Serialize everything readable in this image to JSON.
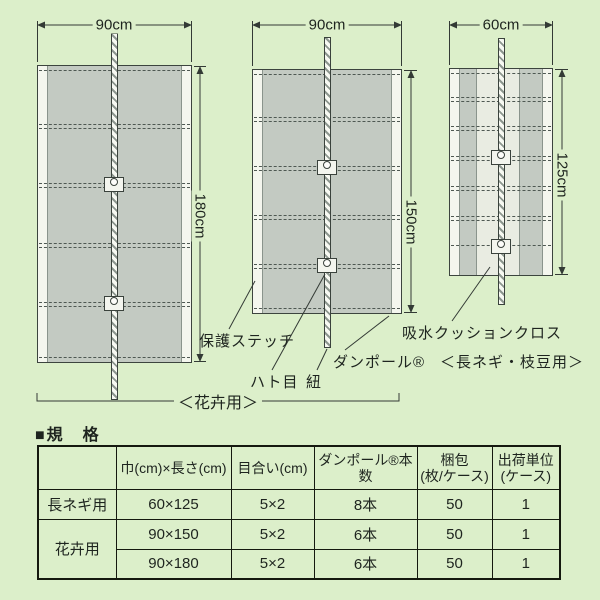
{
  "colors": {
    "background": "#dcefca",
    "panel_gray": "#c3cac2",
    "stitch_white": "#f4f6ee",
    "cushion_light": "#e9ece2",
    "line": "#333a35"
  },
  "diagram": {
    "panels": [
      {
        "width_label": "90cm",
        "height_label": "180cm"
      },
      {
        "width_label": "90cm",
        "height_label": "150cm"
      },
      {
        "width_label": "60cm",
        "height_label": "125cm"
      }
    ],
    "labels": {
      "protective_stitch": "保護ステッチ",
      "eyelet": "ハト目",
      "cord": "紐",
      "danpole": "ダンポール®",
      "cushion_cloth": "吸水クッションクロス",
      "flower_use": "＜花卉用＞",
      "negi_use": "＜長ネギ・枝豆用＞"
    }
  },
  "spec_table": {
    "title": "■規　格",
    "headers": [
      "",
      "巾(cm)×長さ(cm)",
      "目合い(cm)",
      "ダンポール®本数",
      "梱包\n(枚/ケース)",
      "出荷単位\n(ケース)"
    ],
    "rows": [
      {
        "use": "長ネギ用",
        "size": "60×125",
        "mesh": "5×2",
        "poles": "8本",
        "pack": "50",
        "unit": "1"
      },
      {
        "use": "花卉用",
        "size": "90×150",
        "mesh": "5×2",
        "poles": "6本",
        "pack": "50",
        "unit": "1"
      },
      {
        "use": "",
        "size": "90×180",
        "mesh": "5×2",
        "poles": "6本",
        "pack": "50",
        "unit": "1"
      }
    ]
  }
}
